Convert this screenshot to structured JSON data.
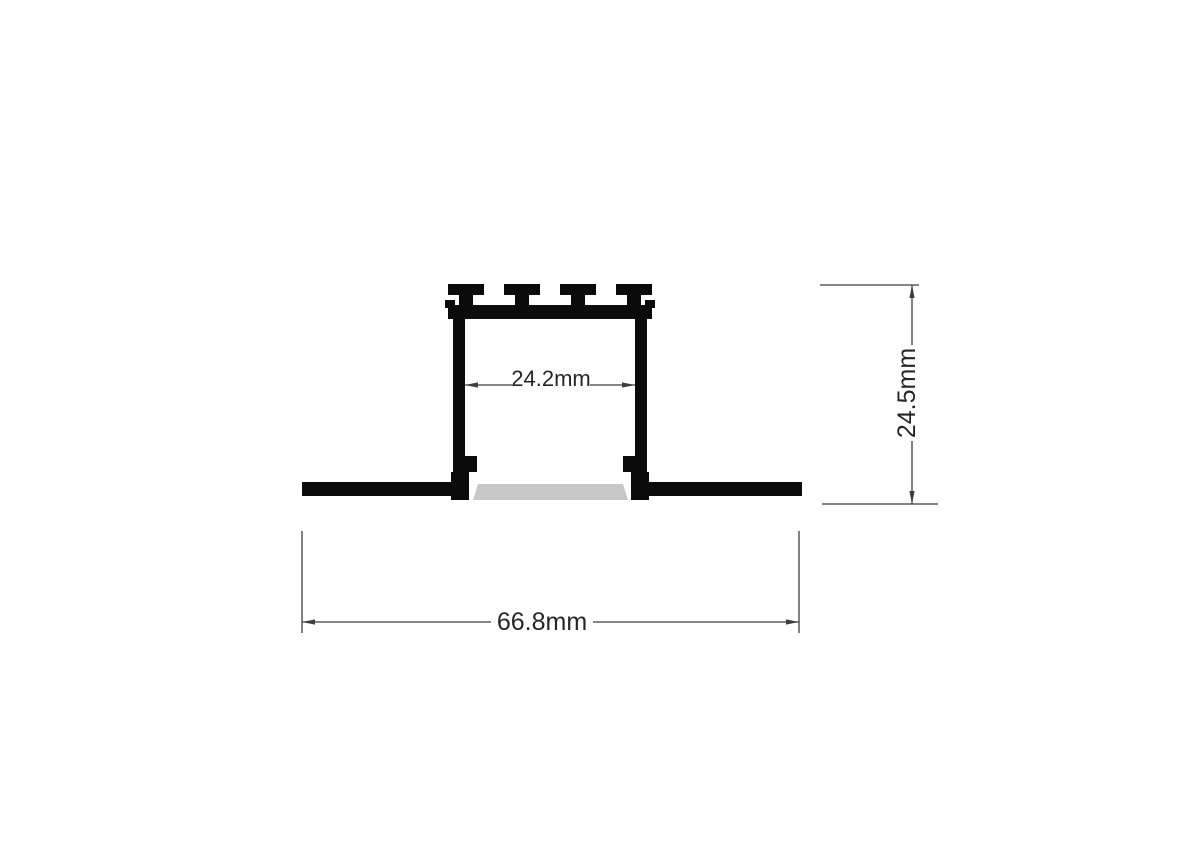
{
  "drawing": {
    "labels": {
      "inner_width": "24.2mm",
      "height": "24.5mm",
      "overall_width": "66.8mm"
    },
    "colors": {
      "profile": "#0b0b0b",
      "diffuser": "#c7c7c7",
      "dimension_line": "#3d3d3d",
      "label_text": "#262626",
      "background": "#ffffff"
    }
  }
}
